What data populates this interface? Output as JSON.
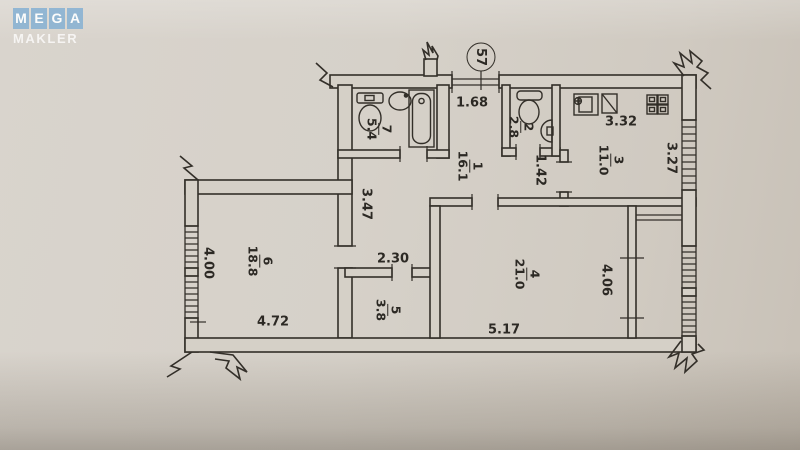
{
  "watermark": {
    "line1_letters": [
      "M",
      "E",
      "G",
      "A"
    ],
    "line2": "MAKLER",
    "tile_color": "#8db4d3",
    "text_color": "#ffffff"
  },
  "plan": {
    "unit_number": "57",
    "ink_color": "#332f29",
    "paper_color": "#d5d0c7",
    "rooms": {
      "r1": {
        "number": "1",
        "area": "16.1"
      },
      "r2": {
        "number": "2",
        "area": "2.8"
      },
      "r3": {
        "number": "3",
        "area": "11.0"
      },
      "r4": {
        "number": "4",
        "area": "21.0"
      },
      "r5": {
        "number": "5",
        "area": "3.8"
      },
      "r6": {
        "number": "6",
        "area": "18.8"
      },
      "r7": {
        "number": "7",
        "area": "5.4"
      }
    },
    "dimensions": {
      "entry_width": "1.68",
      "wc_nook_width": "1.42",
      "kitchen_width": "3.32",
      "kitchen_depth": "3.27",
      "hall_depth": "3.47",
      "corridor_width": "2.30",
      "room6_depth": "4.00",
      "room6_width": "4.72",
      "room4_width": "5.17",
      "room4_depth": "4.06"
    }
  }
}
